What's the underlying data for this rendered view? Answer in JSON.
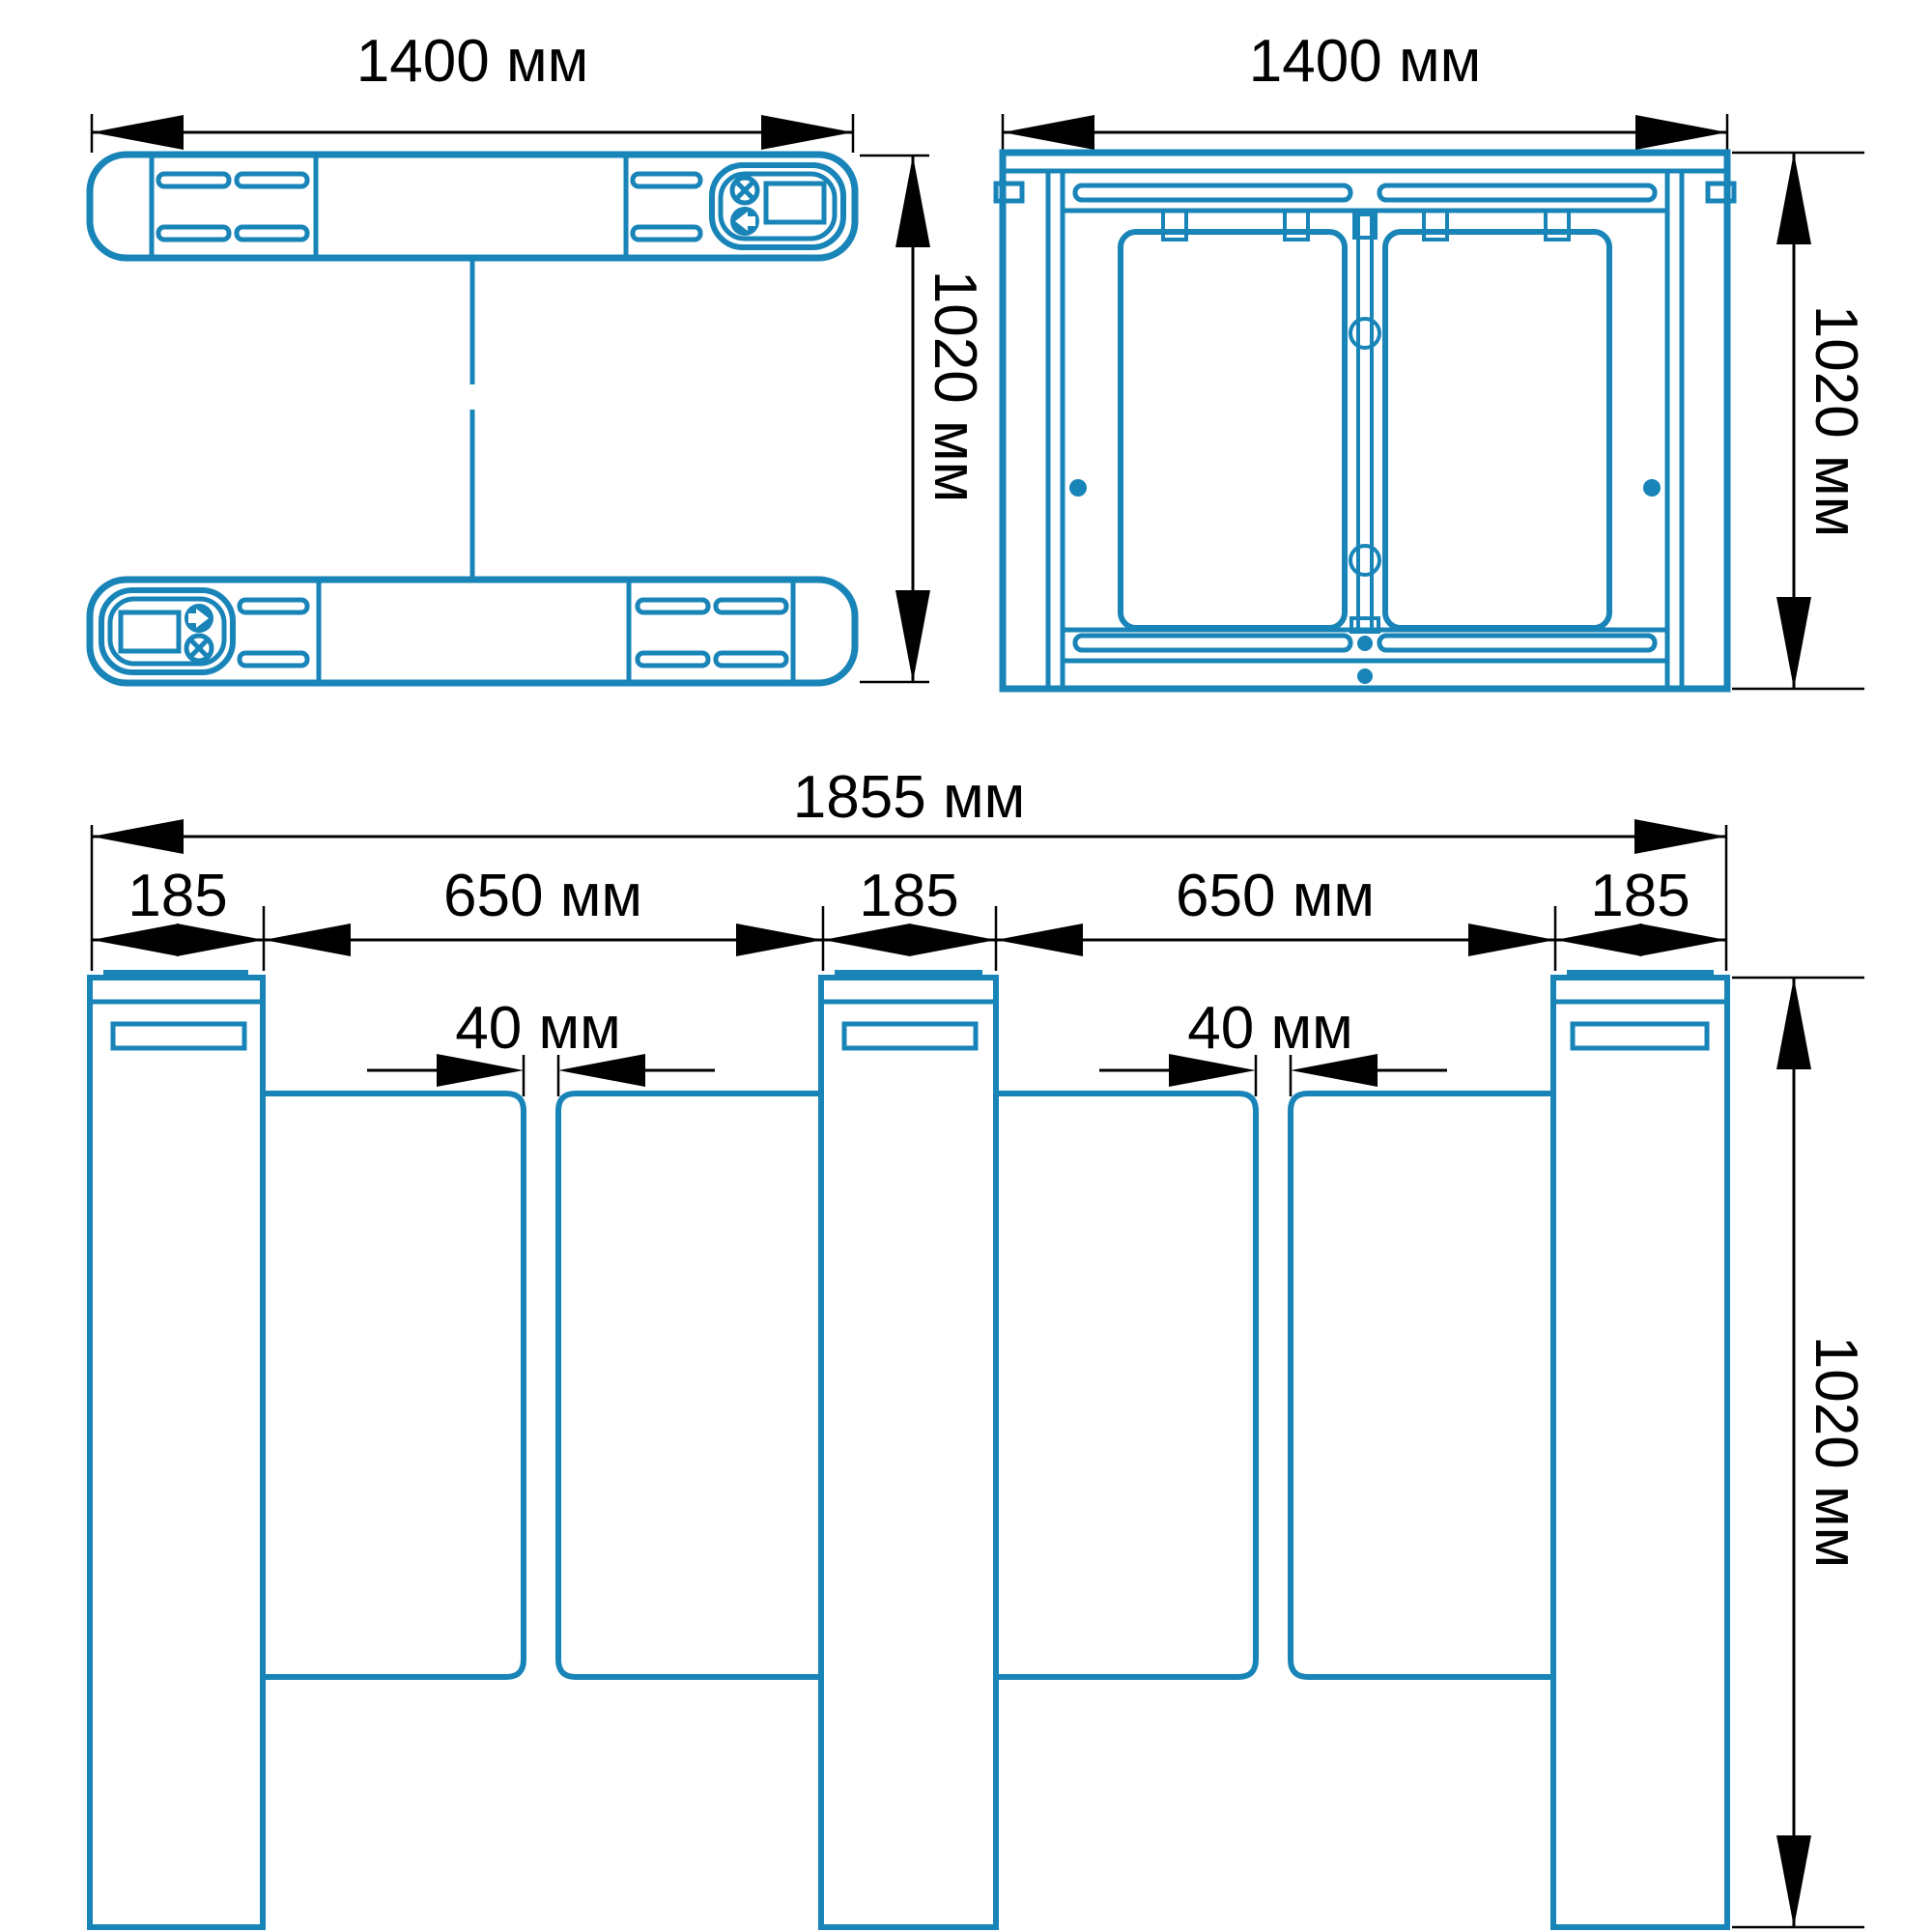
{
  "colors": {
    "line": "#1884B8",
    "dim": "#000000",
    "bg": "#FFFFFF"
  },
  "icons": {
    "no_entry": "no-entry-icon",
    "entry_direction": "entry-arrow-icon",
    "reader_display": "reader-display-window"
  },
  "views": {
    "plan": {
      "width_label": "1400 мм",
      "depth_label": "1020 мм"
    },
    "front": {
      "width_label": "1400 мм",
      "height_label": "1020 мм"
    },
    "elevation": {
      "total_width_label": "1855 мм",
      "segments": [
        "185",
        "650 мм",
        "185",
        "650 мм",
        "185"
      ],
      "gaps": [
        "40 мм",
        "40 мм"
      ],
      "height_label": "1020 мм"
    }
  }
}
